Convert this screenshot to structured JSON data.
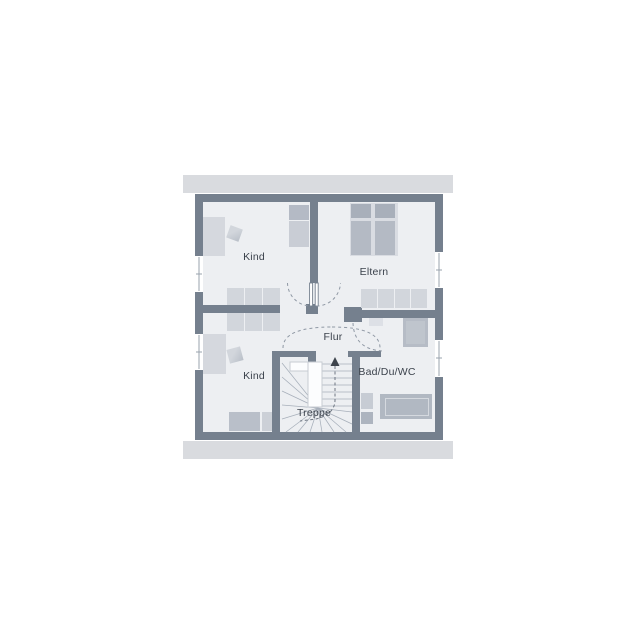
{
  "plan_title": "floor-plan-upper-storey",
  "rooms": [
    {
      "id": "kind-1",
      "label": "Kind"
    },
    {
      "id": "eltern",
      "label": "Eltern"
    },
    {
      "id": "kind-2",
      "label": "Kind"
    },
    {
      "id": "flur",
      "label": "Flur"
    },
    {
      "id": "treppe",
      "label": "Treppe"
    },
    {
      "id": "bad-du-wc",
      "label": "Bad/Du/WC"
    }
  ],
  "icons": [
    {
      "name": "stairs-up-arrow-icon",
      "meaning": "stair direction up"
    }
  ],
  "colors": {
    "wall": "#75808e",
    "floor": "#edeff2",
    "roof_band": "#d9dbdf",
    "furniture_light": "#d2d6dc",
    "furniture_mid": "#b6bcc6",
    "furniture_dark": "#a8afba",
    "door_arc": "#8f98a4",
    "label_text": "#3b424c"
  }
}
